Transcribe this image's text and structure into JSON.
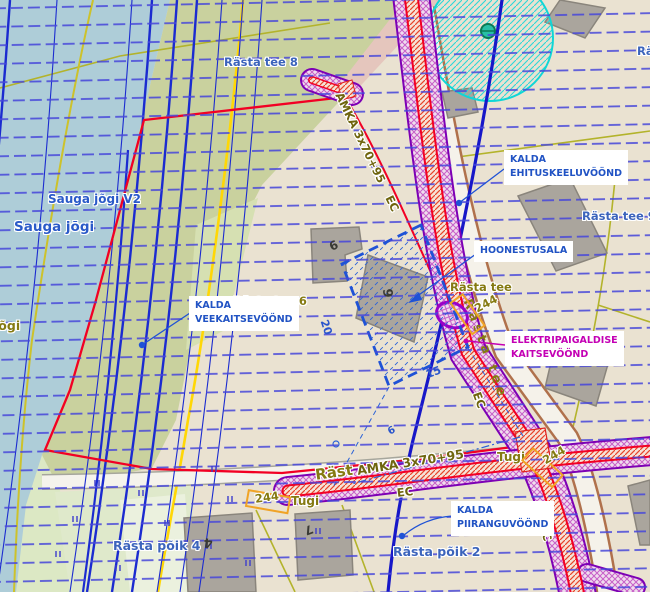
{
  "labels": {
    "streets": {
      "rasta_tee_8": "Rästa tee 8",
      "rasta_tee_9": "Rästa tee 9",
      "rasta_tee_6": "Rästa tee 6",
      "rasta_tee": "Rästa tee",
      "rasta_poik_4": "Rästa põik 4",
      "rasta_poik_2": "Rästa põik 2",
      "rast_partial": "Räst",
      "ra_partial": "Rä"
    },
    "water": {
      "sauga_jogi": "Sauga jõgi",
      "sauga_jogi_v": "Sauga jõgi V2",
      "jogi_partial": "jõgi"
    },
    "zones": {
      "veekaitse_1": "KALDA",
      "veekaitse_2": "VEEKAITSEVÖÖND",
      "ehituskeelu_1": "KALDA",
      "ehituskeelu_2": "EHITUSKEELUVÖÖND",
      "hoonestusala": "HOONESTUSALA",
      "elektri_1": "ELEKTRIPAIGALDISE",
      "elektri_2": "KAITSEVÖÖND",
      "piirangu_1": "KALDA",
      "piirangu_2": "PIIRANGUVÖÖND"
    },
    "utilities": {
      "cable_type": "AMKA 3x70+95",
      "cable_code": "EC",
      "support": "Tugi",
      "support_number": "244"
    },
    "dimensions": {
      "side_long": "20",
      "side_short": "15",
      "setback": "6"
    },
    "house_numbers": {
      "n6": "6",
      "n9": "9",
      "n7": "7",
      "n4": "4",
      "n7b": "7"
    }
  },
  "colors": {
    "water": "#aecdd8",
    "land_olive": "#c9d19e",
    "land_beige": "#eae2d1",
    "zone_label_blue": "#2153c4",
    "zone_label_magenta": "#c400b4",
    "street_label_blue": "#3c64bc",
    "cadastral_olive": "#857a12",
    "corridor_purple": "#7d00b5",
    "boundary_red": "#f20024",
    "road_yellow": "#ffd705",
    "support_orange": "#f0a326",
    "protection_cyan": "#10d6d6"
  }
}
